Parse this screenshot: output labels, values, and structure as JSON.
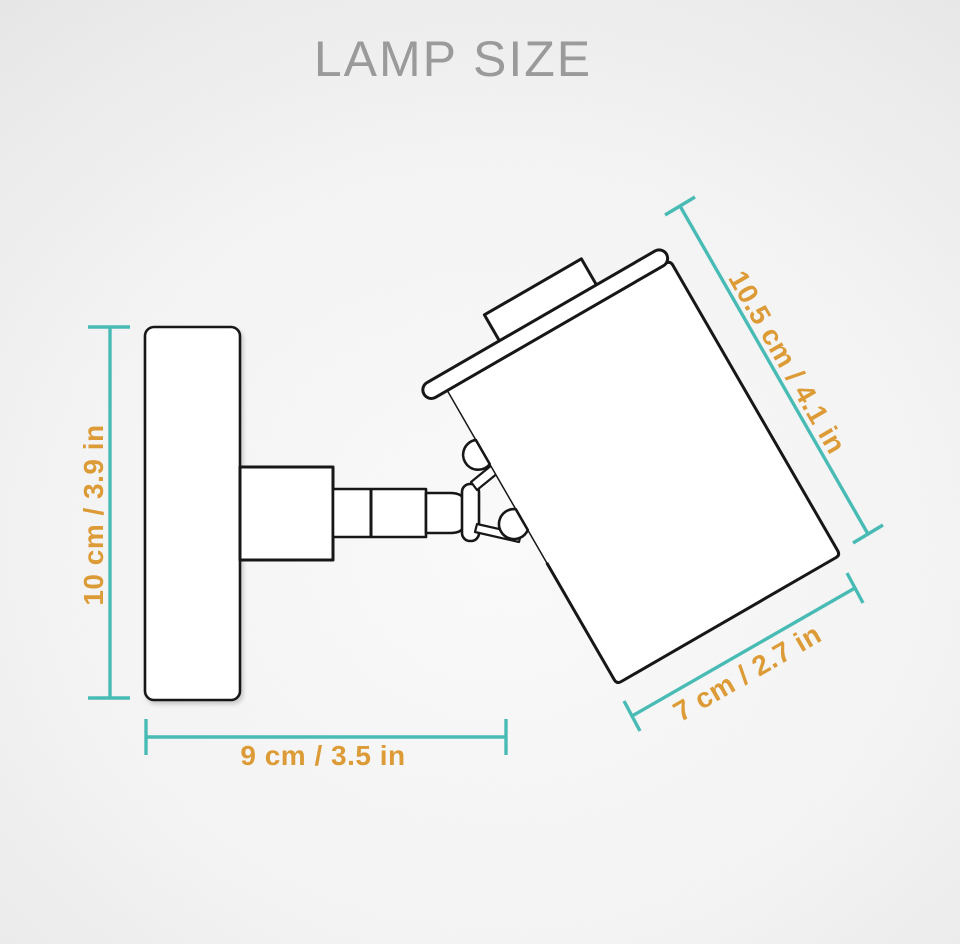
{
  "title": "LAMP SIZE",
  "dimensions": {
    "wall_plate_height": {
      "label": "10 cm / 3.9 in"
    },
    "depth": {
      "label": "9 cm / 3.5 in"
    },
    "head_length": {
      "label": "10.5 cm / 4.1 in"
    },
    "head_diameter": {
      "label": "7 cm / 2.7 in"
    }
  },
  "colors": {
    "dimension_line": "#49bbb5",
    "dimension_text": "#dc9b36",
    "drawing_outline": "#171717",
    "title_text": "#9a9a9a",
    "background_edge": "#cbcbcb",
    "background_center": "#fbfbfb"
  }
}
